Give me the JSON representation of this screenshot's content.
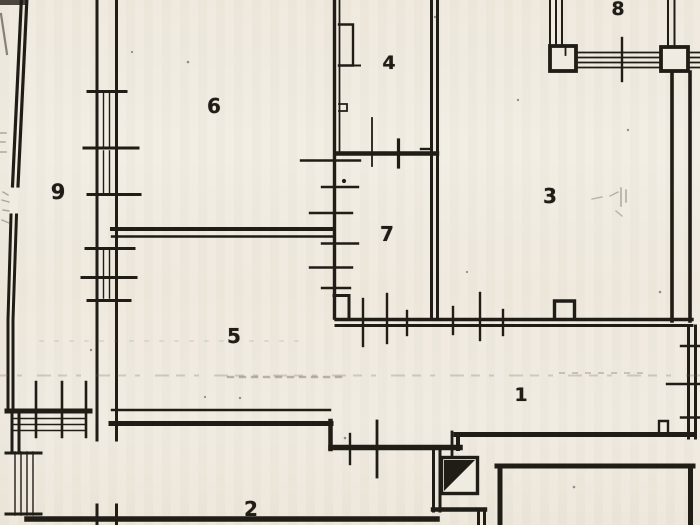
{
  "plan": {
    "title": "apartment-floor-plan",
    "rooms": [
      {
        "id": "room-1",
        "label": "1"
      },
      {
        "id": "room-2",
        "label": "2"
      },
      {
        "id": "room-3",
        "label": "3"
      },
      {
        "id": "room-4",
        "label": "4"
      },
      {
        "id": "room-5",
        "label": "5"
      },
      {
        "id": "room-6",
        "label": "6"
      },
      {
        "id": "room-7",
        "label": "7"
      },
      {
        "id": "room-8",
        "label": "8"
      },
      {
        "id": "room-9",
        "label": "9"
      }
    ],
    "symbols": {
      "shaft_icon": "filled-triangle-square",
      "window_icon": "parallel-mullion-lines",
      "door_tick_icon": "perpendicular-tick"
    },
    "colors": {
      "paper": "#f0ebe1",
      "ink": "#201c16",
      "smudge": "#6e6557"
    }
  }
}
